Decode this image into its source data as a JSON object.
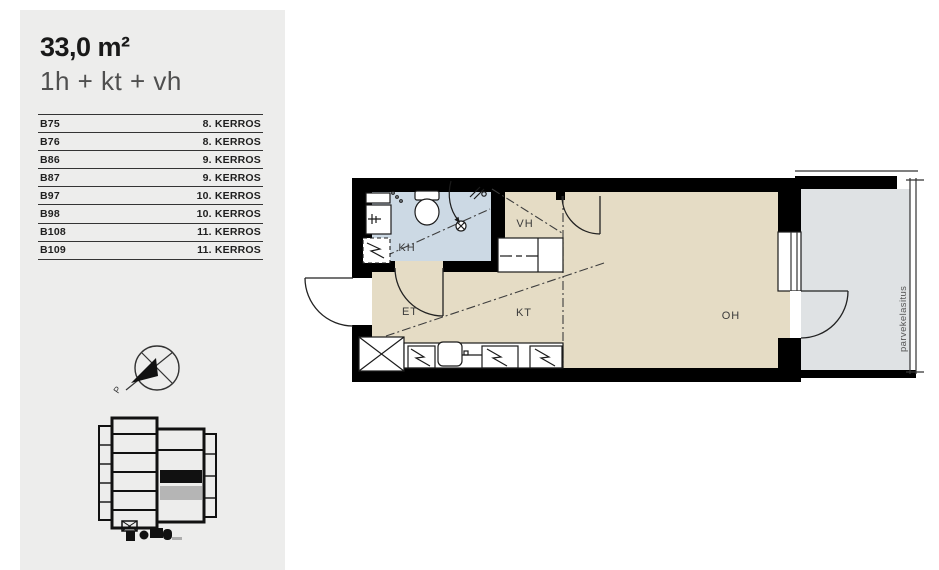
{
  "panel": {
    "area_label": "33,0 m²",
    "room_config": "1h + kt + vh",
    "apartments": [
      {
        "id": "B75",
        "floor": "8. KERROS"
      },
      {
        "id": "B76",
        "floor": "8. KERROS"
      },
      {
        "id": "B86",
        "floor": "9. KERROS"
      },
      {
        "id": "B87",
        "floor": "9. KERROS"
      },
      {
        "id": "B97",
        "floor": "10. KERROS"
      },
      {
        "id": "B98",
        "floor": "10. KERROS"
      },
      {
        "id": "B108",
        "floor": "11. KERROS"
      },
      {
        "id": "B109",
        "floor": "11. KERROS"
      }
    ],
    "compass_north_label": "P"
  },
  "floorplan": {
    "room_labels": {
      "bathroom": "KH",
      "closet": "VH",
      "entry": "ET",
      "kitchen": "KT",
      "living": "OH",
      "balcony_glazing": "parvekelasitus"
    },
    "colors": {
      "wall": "#000000",
      "floor": "#e5dcc5",
      "bathroom": "#ccd9e4",
      "balcony": "#dfe2e4",
      "sidebar_bg": "#ededec"
    }
  }
}
